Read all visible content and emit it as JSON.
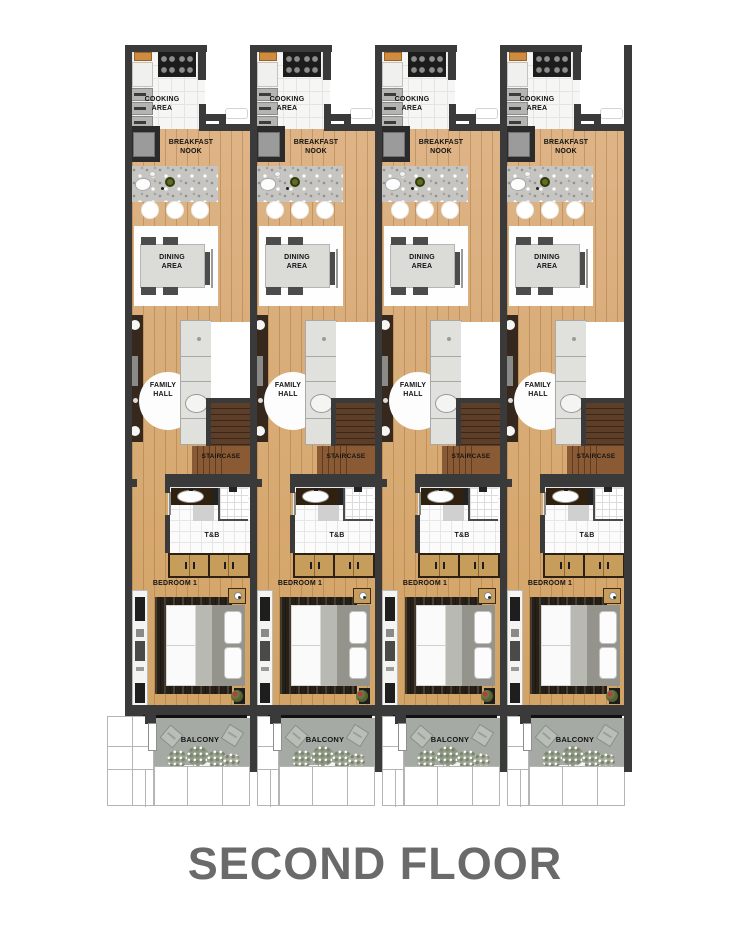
{
  "title": "SECOND FLOOR",
  "floor_plan": {
    "unit_count": 4,
    "labels": {
      "cooking_area": [
        "COOKING",
        "AREA"
      ],
      "breakfast_nook": [
        "BREAKFAST",
        "NOOK"
      ],
      "dining_area": [
        "DINING",
        "AREA"
      ],
      "family_hall": [
        "FAMILY",
        "HALL"
      ],
      "staircase": "STAIRCASE",
      "toilet_bath": "T&B",
      "bedroom": "BEDROOM 1",
      "balcony": "BALCONY"
    },
    "colors": {
      "wall": "#3a3a3a",
      "wood1": "#deb487",
      "wood2": "#d2a365",
      "granite": "#c6c5c2",
      "stair_dark": "#5d3e28",
      "stair_mid": "#8a5a34",
      "wardrobe": "#c79d5c",
      "balcony_floor": "#a5aba4",
      "rug": "#262019",
      "blanket": "#b9b9b3",
      "headboard": "#94948c",
      "label_text": "#141414",
      "title_text": "#6a6a6a"
    }
  }
}
